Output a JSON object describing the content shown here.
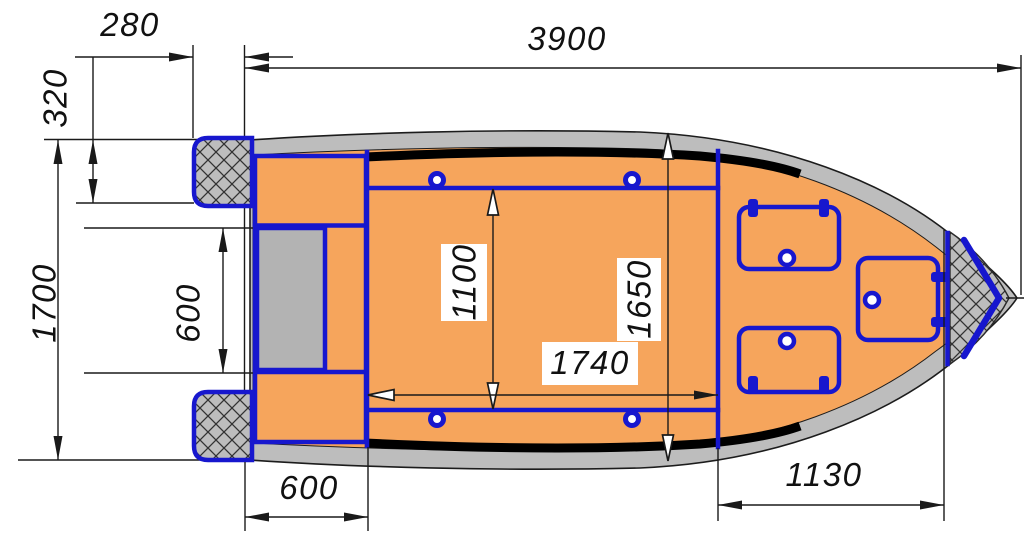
{
  "drawing": {
    "title": "Boat top-view dimension drawing",
    "units": "mm",
    "labels": {
      "dim_280": "280",
      "dim_3900": "3900",
      "dim_320": "320",
      "dim_1700": "1700",
      "dim_600_motor_well": "600",
      "dim_1100": "1100",
      "dim_1650": "1650",
      "dim_1740": "1740",
      "dim_600_aft_deck": "600",
      "dim_1130": "1130"
    }
  },
  "colors": {
    "deck": "#f6a55c",
    "hull": "#bdbdbd",
    "well": "#b3b3b3",
    "accent": "#1717ce",
    "line": "#1a1a1a",
    "stripe": "#000000",
    "bg": "#ffffff"
  }
}
